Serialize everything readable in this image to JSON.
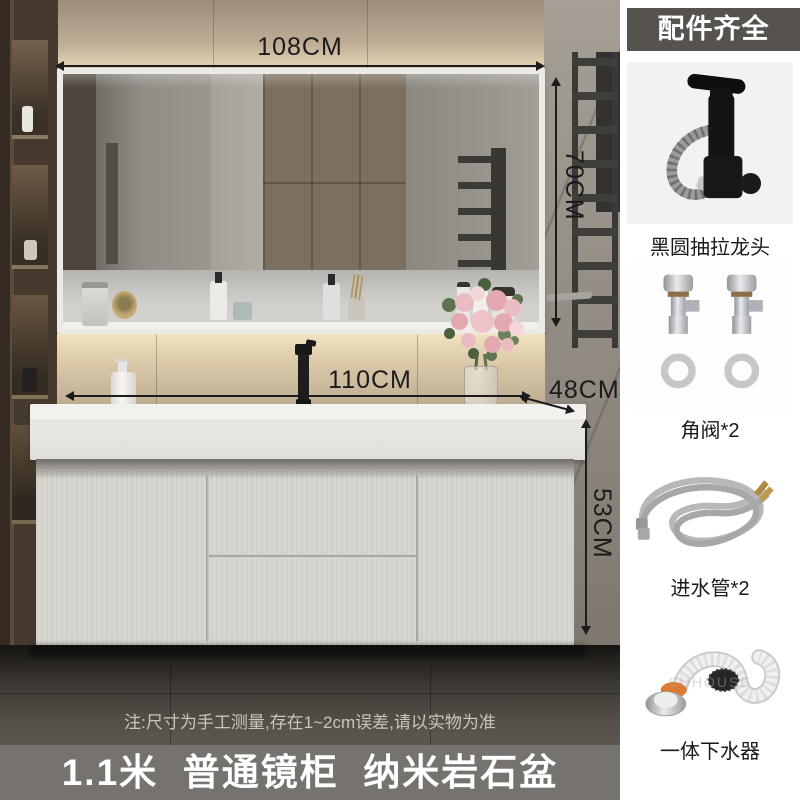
{
  "annotations": {
    "mirror_width": "108CM",
    "mirror_height": "70CM",
    "counter_width": "110CM",
    "counter_depth": "48CM",
    "cabinet_height": "53CM"
  },
  "note": "注:尺寸为手工测量,存在1~2cm误差,请以实物为准",
  "banner": "1.1米  普通镜柜  纳米岩石盆",
  "sidebar": {
    "title": "配件齐全",
    "items": [
      {
        "label": "黑圆抽拉龙头"
      },
      {
        "label": "角阀*2"
      },
      {
        "label": "进水管*2"
      },
      {
        "label": "一体下水器"
      }
    ]
  },
  "watermark": "SUHOUSE",
  "colors": {
    "dimension_ink": "#1c1c1c",
    "header_bg": "#56524d",
    "banner_bg": "#76726e",
    "accent_orange": "#dd7b33",
    "sidebar_bg": "#ffffff"
  }
}
